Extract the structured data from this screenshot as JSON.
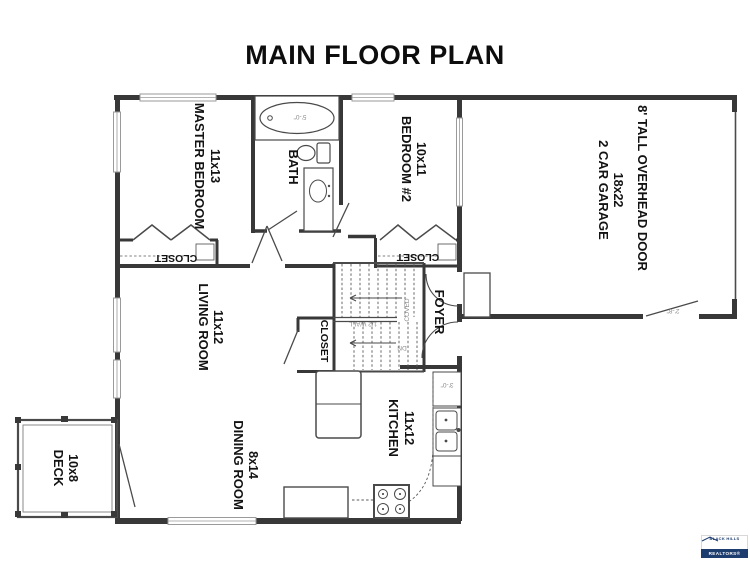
{
  "title": "MAIN FLOOR PLAN",
  "rooms": {
    "master": {
      "name": "MASTER BEDROOM",
      "dims": "11x13"
    },
    "bath": {
      "name": "BATH"
    },
    "bedroom2": {
      "name": "BEDROOM #2",
      "dims": "10x11"
    },
    "garage": {
      "name": "2 CAR GARAGE",
      "dims": "18x22",
      "note": "8' TALL OVERHEAD DOOR"
    },
    "living": {
      "name": "LIVING ROOM",
      "dims": "11x12"
    },
    "foyer": {
      "name": "FOYER"
    },
    "dining": {
      "name": "DINING ROOM",
      "dims": "8x14"
    },
    "kitchen": {
      "name": "KITCHEN",
      "dims": "11x12"
    },
    "deck": {
      "name": "DECK",
      "dims": "10x8"
    },
    "closet_master": {
      "name": "CLOSET"
    },
    "closet_bedroom2": {
      "name": "CLOSET"
    },
    "closet_hall": {
      "name": "CLOSET"
    }
  },
  "annotations": {
    "tub_width": "5'-0\"",
    "half_wall": "1/2 WALL",
    "down": "DN",
    "coved": "COVED",
    "dishwasher": "3'-0\"",
    "garage_door": "2'-8\""
  },
  "logo": {
    "line1": "BLACK HILLS",
    "line2": "REALTORS®"
  },
  "colors": {
    "wall": "#383838",
    "annotation": "#8a8a8a",
    "logo_blue": "#1d3d6e"
  }
}
